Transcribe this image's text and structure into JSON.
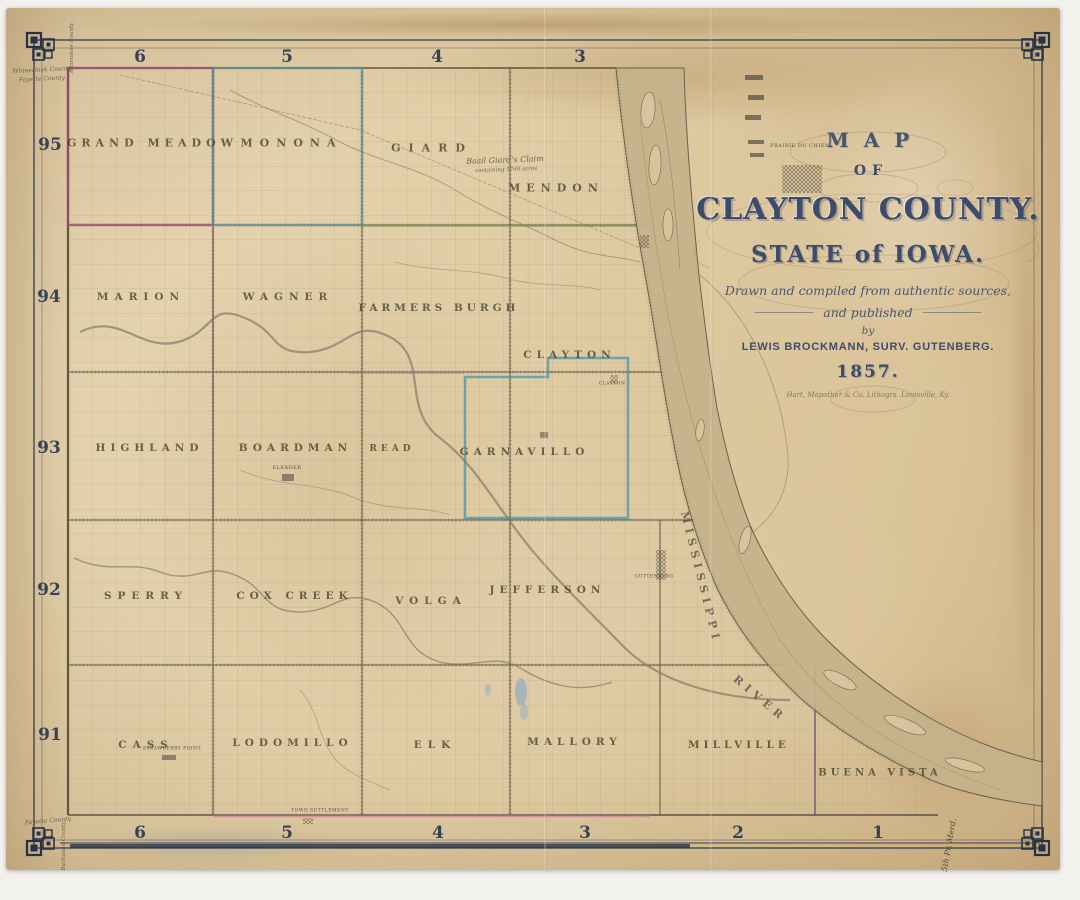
{
  "artwork": {
    "kind": "antique county land-survey map, scanned, aged paper",
    "title_block": {
      "map_word": "MAP",
      "of_word": "OF",
      "county_line": "CLAYTON COUNTY.",
      "state_line": "STATE of IOWA.",
      "subtitle1": "Drawn and compiled from authentic sources,",
      "subtitle2": "and published",
      "subtitle3": "by",
      "publisher_line": "LEWIS BROCKMANN, SURV. GUTENBERG.",
      "year": "1857.",
      "imprint": "Hart, Mapother & Co. Lithogrs. Louisville, Ky."
    },
    "ink_color": "#3d4c6c",
    "paper_color": "#e0cda6"
  },
  "grid_labels": {
    "top": [
      {
        "text": "6",
        "x": 140,
        "y": 57
      },
      {
        "text": "5",
        "x": 287,
        "y": 57
      },
      {
        "text": "4",
        "x": 437,
        "y": 57
      },
      {
        "text": "3",
        "x": 580,
        "y": 57
      }
    ],
    "bottom": [
      {
        "text": "6",
        "x": 140,
        "y": 833
      },
      {
        "text": "5",
        "x": 287,
        "y": 833
      },
      {
        "text": "4",
        "x": 438,
        "y": 833
      },
      {
        "text": "3",
        "x": 585,
        "y": 833
      },
      {
        "text": "2",
        "x": 738,
        "y": 833
      },
      {
        "text": "1",
        "x": 878,
        "y": 833
      }
    ],
    "left": [
      {
        "text": "95",
        "x": 50,
        "y": 145
      },
      {
        "text": "94",
        "x": 49,
        "y": 297
      },
      {
        "text": "93",
        "x": 49,
        "y": 448
      },
      {
        "text": "92",
        "x": 49,
        "y": 590
      },
      {
        "text": "91",
        "x": 50,
        "y": 735
      }
    ]
  },
  "townships": [
    {
      "name": "GRAND MEADOW",
      "x": 150,
      "y": 143,
      "size": 11,
      "ls": 5
    },
    {
      "name": "MONONA",
      "x": 288,
      "y": 143,
      "size": 11,
      "ls": 7
    },
    {
      "name": "GIARD",
      "x": 428,
      "y": 148,
      "size": 11,
      "ls": 8
    },
    {
      "name": "MENDON",
      "x": 553,
      "y": 188,
      "size": 11,
      "ls": 6
    },
    {
      "name": "MARION",
      "x": 138,
      "y": 297,
      "size": 10.5,
      "ls": 6
    },
    {
      "name": "WAGNER",
      "x": 285,
      "y": 297,
      "size": 10.5,
      "ls": 6
    },
    {
      "name": "FARMERS BURGH",
      "x": 437,
      "y": 308,
      "size": 10.5,
      "ls": 4
    },
    {
      "name": "CLAYTON",
      "x": 567,
      "y": 355,
      "size": 10.5,
      "ls": 5
    },
    {
      "name": "HIGHLAND",
      "x": 147,
      "y": 448,
      "size": 10.5,
      "ls": 5
    },
    {
      "name": "BOARDMAN",
      "x": 293,
      "y": 448,
      "size": 10.5,
      "ls": 5
    },
    {
      "name": "READ",
      "x": 390,
      "y": 449,
      "size": 9,
      "ls": 4
    },
    {
      "name": "GARNAVILLO",
      "x": 522,
      "y": 452,
      "size": 10.5,
      "ls": 5
    },
    {
      "name": "SPERRY",
      "x": 143,
      "y": 596,
      "size": 10.5,
      "ls": 6
    },
    {
      "name": "COX CREEK",
      "x": 292,
      "y": 596,
      "size": 10.5,
      "ls": 5
    },
    {
      "name": "VOLGA",
      "x": 428,
      "y": 601,
      "size": 10.5,
      "ls": 6
    },
    {
      "name": "JEFFERSON",
      "x": 545,
      "y": 590,
      "size": 10.5,
      "ls": 5
    },
    {
      "name": "CASS",
      "x": 143,
      "y": 745,
      "size": 10.5,
      "ls": 6
    },
    {
      "name": "LODOMILLO",
      "x": 290,
      "y": 743,
      "size": 10.5,
      "ls": 5
    },
    {
      "name": "ELK",
      "x": 432,
      "y": 745,
      "size": 10.5,
      "ls": 6
    },
    {
      "name": "MALLORY",
      "x": 572,
      "y": 742,
      "size": 10.5,
      "ls": 5
    },
    {
      "name": "MILLVILLE",
      "x": 737,
      "y": 745,
      "size": 10.5,
      "ls": 4
    },
    {
      "name": "BUENA VISTA",
      "x": 878,
      "y": 773,
      "size": 10,
      "ls": 4
    }
  ],
  "river_labels": [
    {
      "text": "MISSISSIPPI",
      "x": 700,
      "y": 575,
      "size": 11,
      "rot": 76,
      "ls": 5
    },
    {
      "text": "RIVER",
      "x": 758,
      "y": 697,
      "size": 11,
      "rot": 40,
      "ls": 5
    }
  ],
  "map_labels": [
    {
      "text": "Basil Giard's Claim",
      "x": 505,
      "y": 160,
      "size": 8,
      "rot": -2,
      "cls": "script"
    },
    {
      "text": "containing 5760 acres",
      "x": 506,
      "y": 170,
      "size": 5.5,
      "rot": -2,
      "cls": "script"
    },
    {
      "text": "PRAIRIE DU CHIEN",
      "x": 800,
      "y": 146,
      "size": 5,
      "rot": 0,
      "cls": "tinycaps"
    },
    {
      "text": "ELKADER",
      "x": 287,
      "y": 468,
      "size": 5,
      "rot": 0,
      "cls": "tinycaps"
    },
    {
      "text": "STRAWBERRY POINT",
      "x": 172,
      "y": 749,
      "size": 4.5,
      "rot": 0,
      "cls": "tinycaps"
    },
    {
      "text": "GUTTENBERG",
      "x": 654,
      "y": 577,
      "size": 4.5,
      "rot": 0,
      "cls": "tinycaps"
    },
    {
      "text": "CLAYTON",
      "x": 612,
      "y": 384,
      "size": 4.5,
      "rot": 0,
      "cls": "tinycaps"
    },
    {
      "text": "TOWN SETTLEMENT",
      "x": 320,
      "y": 811,
      "size": 4.5,
      "rot": 0,
      "cls": "tinycaps"
    },
    {
      "text": "Winneshiek County",
      "x": 42,
      "y": 70,
      "size": 6,
      "rot": -3,
      "cls": "script"
    },
    {
      "text": "Fayette County",
      "x": 42,
      "y": 79,
      "size": 6,
      "rot": -3,
      "cls": "script"
    },
    {
      "text": "Allamakee County",
      "x": 72,
      "y": 48,
      "size": 5.5,
      "rot": -90,
      "cls": "script"
    },
    {
      "text": "Fayette County",
      "x": 48,
      "y": 821,
      "size": 6,
      "rot": -5,
      "cls": "script"
    },
    {
      "text": "Buchanan County",
      "x": 64,
      "y": 846,
      "size": 5.5,
      "rot": -90,
      "cls": "script"
    },
    {
      "text": "5th Pr. Merd.",
      "x": 949,
      "y": 845,
      "size": 8,
      "rot": -80,
      "cls": "script-dark"
    }
  ]
}
